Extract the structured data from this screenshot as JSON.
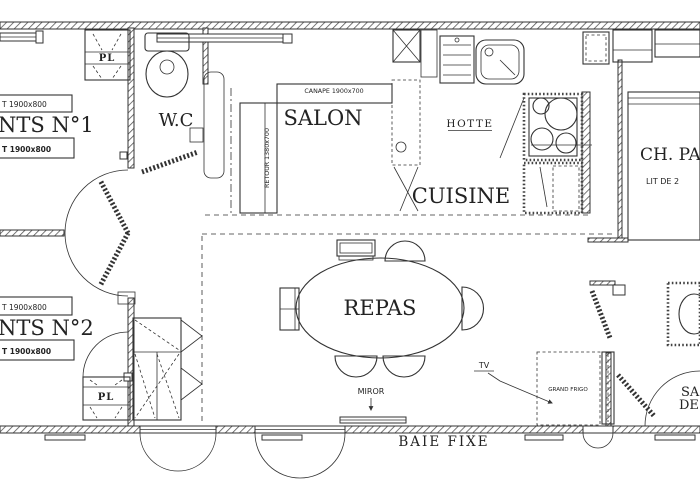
{
  "colors": {
    "ink": "#333333",
    "paper": "#ffffff"
  },
  "rooms": {
    "wc": "W.C",
    "salon": "SALON",
    "cuisine": "CUISINE",
    "repas": "REPAS",
    "parents": "CH. PA",
    "parents_bed": "LIT DE 2",
    "enfants1": "NTS N°1",
    "enfants2": "NTS N°2",
    "salle_eau_line1": "SA",
    "salle_eau_line2": "DE"
  },
  "furniture": {
    "canape": "CANAPE 1900x700",
    "retour": "RETOUR 1380x700",
    "hotte": "HOTTE",
    "placard_top": "PL",
    "placard_bottom": "PL",
    "grand_frigo": "GRAND FRIGO",
    "tv": "TV",
    "miror": "MIROR",
    "baie_fixe": "BAIE FIXE",
    "bed1_room1": "T 1900x800",
    "bed2_room1": "T 1900x800",
    "bed1_room2": "T 1900x800",
    "bed2_room2": "T 1900x800"
  }
}
